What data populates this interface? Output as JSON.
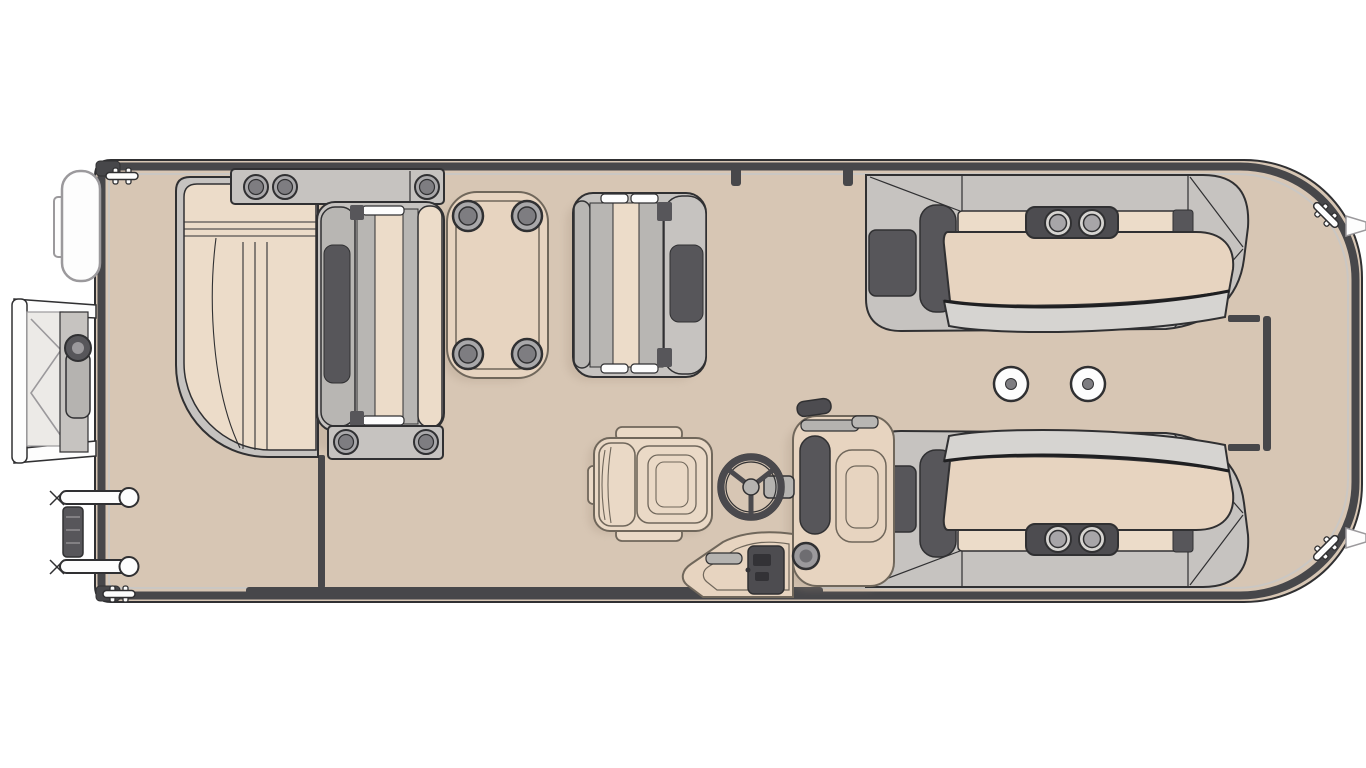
{
  "page": {
    "label": "Pontoon boat floor plan (top view)",
    "background": "#ffffff"
  },
  "colors": {
    "page_bg": "#ffffff",
    "deck": "#d7c6b4",
    "rail": "#47474a",
    "outline": "#303032",
    "trim": "#cac7c3",
    "base_gray": "#c6c3c0",
    "base_gray2": "#b8b6b3",
    "mid_gray": "#9b999c",
    "dark_pad": "#57565a",
    "pod_dark": "#4d4c50",
    "cushion": "#ecdcc9",
    "cushion2": "#e7d4c0",
    "cream_chair": "#ead9c6",
    "chair_line": "#70675b",
    "white": "#fdfdfd",
    "steel": "#b5b3b0",
    "ring_light": "#d6d4d1",
    "ring_mid": "#a7a5a8",
    "cup_outer": "#a9a8aa",
    "cup_inner": "#7e7d81",
    "shadow_tone": "#a89582"
  },
  "components": {
    "hull": "pontoon hull with perimeter fence rail",
    "fender": "bow fender pod",
    "boarding_ladder": "fold-down bow boarding ladder",
    "gate_hinges": "bow gate hinge hardware",
    "cleats": "mooring cleats (4)",
    "mooring_tabs": "stern tie-off tabs (2)",
    "bow_lounge": "bow chaise lounge",
    "bow_console": "bow armrest console with cup holders",
    "forward_bench": "forward bench seat with armrest consoles",
    "cocktail_table": "cocktail table with four cup holders",
    "mid_bench": "mid rear-facing bench seat",
    "captains_chair": "captain's swivel chair",
    "helm_console": "helm console with steering wheel and controls",
    "side_gate": "side boarding gate opening",
    "stern_lounge_port": "aft wraparound lounge (port)",
    "stern_lounge_starboard": "aft wraparound lounge (starboard)",
    "cup_holder_pods": "cup holder pods on lounge armrests",
    "table_floor_mounts": "removable table floor mounts (2)",
    "stern_fence": "stern walkway fence section"
  }
}
